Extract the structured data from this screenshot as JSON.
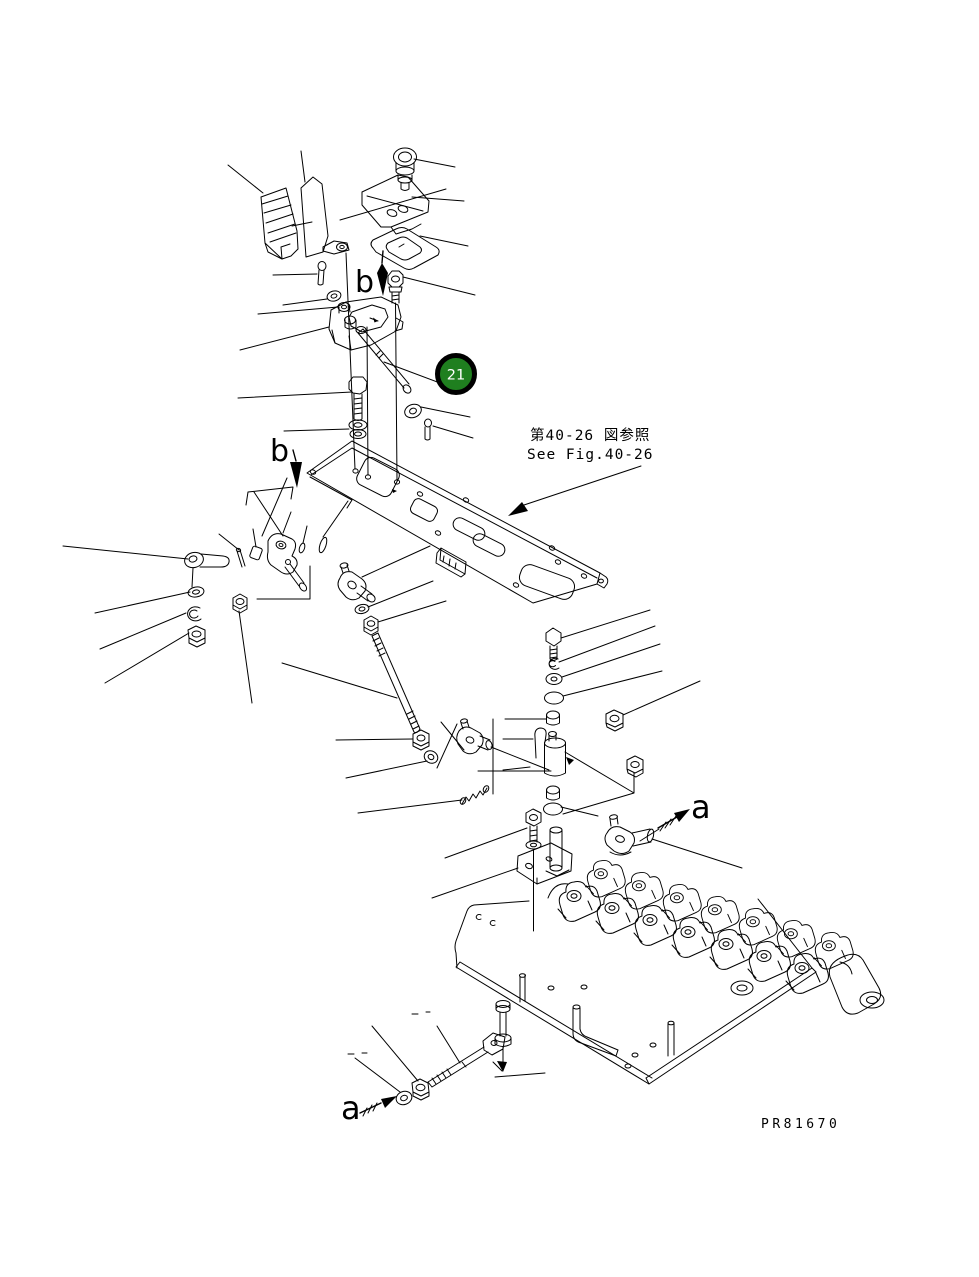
{
  "drawing": {
    "callout": {
      "number": "21"
    },
    "reference_note": {
      "jp": "第40-26 図参照",
      "en": "See Fig.40-26"
    },
    "view_labels": {
      "b_top": "b",
      "b_mid": "b",
      "a_mid": "a",
      "a_bottom": "a"
    },
    "drawing_number": "PR81670",
    "colors": {
      "background": "#ffffff",
      "line": "#000000",
      "callout_fill": "#1f7f1f",
      "callout_ring": "#000000",
      "callout_text": "#ffffff"
    }
  }
}
